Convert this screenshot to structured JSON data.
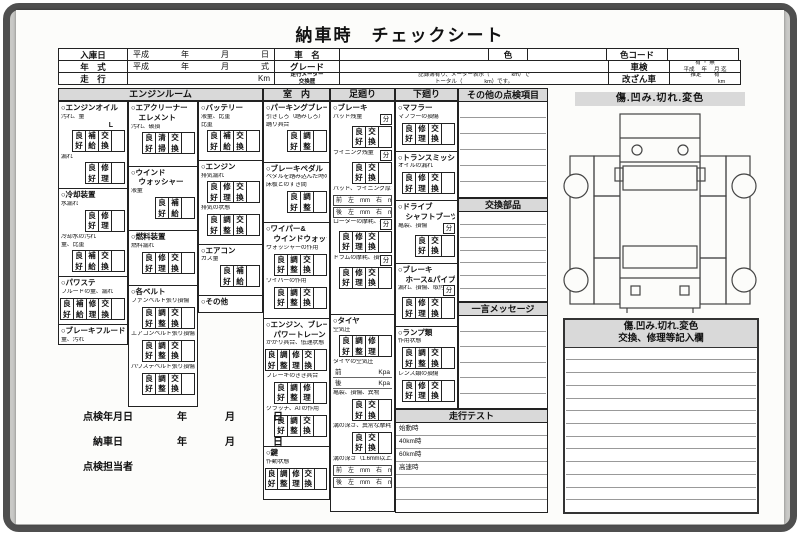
{
  "title": "納車時　チェックシート",
  "bun_label": "分",
  "colors": {
    "mat": "#c9c9c6",
    "frame": "#4f4f4f",
    "paper": "#fcfcfa",
    "shade": "#d9d9d9",
    "line": "#222222"
  },
  "header": {
    "rows": [
      [
        {
          "t": "入庫日",
          "w": 70,
          "h": true
        },
        {
          "t": "平成　　　　年　　　　月　　　　日",
          "w": 148
        },
        {
          "t": "車　名",
          "w": 66,
          "h": true
        },
        {
          "t": "",
          "w": 150
        },
        {
          "t": "色",
          "w": 40,
          "h": true
        },
        {
          "t": "",
          "w": 80
        },
        {
          "t": "色コード",
          "w": 62,
          "h": true
        },
        {
          "t": "",
          "w": 72
        }
      ],
      [
        {
          "t": "年　式",
          "w": 70,
          "h": true
        },
        {
          "t": "平成　　　　年　　　　月　　　　式",
          "w": 148
        },
        {
          "t": "グレード",
          "w": 66,
          "h": true
        },
        {
          "t": "",
          "w": 270
        },
        {
          "t": "車検",
          "w": 62,
          "h": true
        },
        {
          "t": "有 ・ 無\n平成　 年　 月 迄",
          "w": 72,
          "tiny": true
        }
      ],
      [
        {
          "t": "走　行",
          "w": 70,
          "h": true
        },
        {
          "t": "Km",
          "w": 148,
          "align": "right"
        },
        {
          "t": "走行メーター\n交換歴",
          "w": 66,
          "h": true,
          "tiny": true
        },
        {
          "t": "記録簿有り、メーター表示（　　　　km）で\nトータル（　　　　km）です。",
          "w": 270,
          "tiny": true
        },
        {
          "t": "改ざん車",
          "w": 62,
          "h": true
        },
        {
          "t": "推定　　 有\n　　　　　　km",
          "w": 72,
          "tiny": true
        }
      ]
    ]
  },
  "col_headers": {
    "engine_room": "エンジンルーム",
    "interior": "室　内",
    "suspension": "足廻り",
    "lower": "下廻り"
  },
  "engine_room": {
    "columns": [
      {
        "sections": [
          {
            "title": [
              "○エンジンオイル"
            ],
            "items": [
              {
                "label": "汚れ、量",
                "extra": "L",
                "boxes": [
                  "良好",
                  "補給",
                  "交換"
                ]
              },
              {
                "label": "漏れ",
                "boxes": [
                  "良好",
                  "修理"
                ]
              }
            ]
          },
          {
            "title": [
              "○冷却装置"
            ],
            "items": [
              {
                "label": "水漏れ",
                "boxes": [
                  "良好",
                  "修理"
                ]
              },
              {
                "label": "冷却水の汚れ",
                "label2": "量、比重",
                "boxes": [
                  "良好",
                  "補給",
                  "交換"
                ]
              }
            ]
          },
          {
            "title": [
              "○パワステ"
            ],
            "items": [
              {
                "label": "フルードの量、漏れ",
                "boxes": [
                  "良好",
                  "補給",
                  "修理",
                  "交換"
                ]
              }
            ]
          },
          {
            "title": [
              "○ブレーキフルード"
            ],
            "items": [
              {
                "label": "量、汚れ",
                "boxes": [
                  "良好",
                  "補給",
                  "交換"
                ]
              }
            ]
          }
        ]
      },
      {
        "sections": [
          {
            "title": [
              "○エアクリーナー",
              "　エレメント"
            ],
            "items": [
              {
                "label": "汚れ、破損",
                "boxes": [
                  "良好",
                  "清掃",
                  "交換"
                ]
              }
            ]
          },
          {
            "title": [
              "○ウインド",
              "　ウォッシャー"
            ],
            "items": [
              {
                "label": "液量",
                "boxes": [
                  "良好",
                  "補給"
                ]
              }
            ]
          },
          {
            "title": [
              "○燃料装置"
            ],
            "items": [
              {
                "label": "燃料漏れ",
                "boxes": [
                  "良好",
                  "修理",
                  "交換"
                ]
              }
            ]
          },
          {
            "title": [
              "○各ベルト"
            ],
            "items": [
              {
                "label": "ファンベルト張り損傷",
                "boxes": [
                  "良好",
                  "調整",
                  "交換"
                ]
              },
              {
                "label": "エアコンベルト張り損傷",
                "boxes": [
                  "良好",
                  "調整",
                  "交換"
                ]
              },
              {
                "label": "パワステベルト張り損傷",
                "boxes": [
                  "良好",
                  "調整",
                  "交換"
                ]
              }
            ]
          }
        ]
      },
      {
        "sections": [
          {
            "title": [
              "○バッテリー"
            ],
            "items": [
              {
                "label": "液量、比重",
                "label2": "比重",
                "boxes": [
                  "良好",
                  "補給",
                  "交換"
                ]
              }
            ]
          },
          {
            "title": [
              "○エンジン"
            ],
            "items": [
              {
                "label": "排気漏れ",
                "boxes": [
                  "良好",
                  "修理",
                  "交換"
                ]
              },
              {
                "label": "排気の状態",
                "boxes": [
                  "良好",
                  "調整",
                  "交換"
                ]
              }
            ]
          },
          {
            "title": [
              "○エアコン"
            ],
            "items": [
              {
                "label": "ガス量",
                "boxes": [
                  "良好",
                  "補給"
                ]
              }
            ]
          },
          {
            "title": [
              "○その他"
            ],
            "items": []
          }
        ]
      }
    ]
  },
  "interior": {
    "sections": [
      {
        "title": [
          "○パーキングブレーキ"
        ],
        "items": [
          {
            "label": "引きしろ（踏みしろ）",
            "label2": "踊り具合",
            "boxes": [
              "良好",
              "調整"
            ]
          }
        ]
      },
      {
        "title": [
          "○ブレーキペダル"
        ],
        "items": [
          {
            "label": "ペダルを踏み込んだ時の",
            "label2": "床板とのすき間",
            "boxes": [
              "良好",
              "調整"
            ]
          }
        ]
      },
      {
        "title": [
          "○ワイパー&",
          "　ウインドウォッシャー"
        ],
        "items": [
          {
            "label": "ウォッシャーの作用",
            "boxes": [
              "良好",
              "調整",
              "交換"
            ]
          },
          {
            "label": "ワイパーの作用",
            "boxes": [
              "良好",
              "調整",
              "交換"
            ]
          }
        ]
      },
      {
        "title": [
          "○エンジン、ブレーキ",
          "　パワートレーン"
        ],
        "items": [
          {
            "label": "かかり具合、低速状態",
            "boxes": [
              "良好",
              "調整",
              "修理",
              "交換"
            ]
          },
          {
            "label": "ブレーキのきき具合",
            "boxes": [
              "良好",
              "調整",
              "修理"
            ]
          },
          {
            "label": "クラッチ、ATの作用",
            "boxes": [
              "良好",
              "調整",
              "交換"
            ]
          }
        ]
      },
      {
        "title": [
          "○鍵"
        ],
        "items": [
          {
            "label": "作動状態",
            "boxes": [
              "良好",
              "調整",
              "修理",
              "交換"
            ]
          }
        ]
      }
    ]
  },
  "suspension": {
    "sections": [
      {
        "title": [
          "○ブレーキ"
        ],
        "items": [
          {
            "label": "パッド残量",
            "bun": true,
            "boxes": [
              "良好",
              "交換"
            ]
          },
          {
            "label": "ライニング残量",
            "bun": true,
            "boxes": [
              "良好",
              "交換"
            ]
          },
          {
            "label": "パッド、ライニング厚さ",
            "mm": [
              [
                "前",
                "左",
                "mm",
                "右",
                "mm"
              ],
              [
                "後",
                "左",
                "mm",
                "右",
                "mm"
              ]
            ]
          },
          {
            "label": "ローターの摩耗、損傷",
            "bun": true,
            "boxes": [
              "良好",
              "修理",
              "交換"
            ]
          },
          {
            "label": "ドラムの摩耗、損傷",
            "bun": true,
            "boxes": [
              "良好",
              "修理",
              "交換"
            ]
          }
        ]
      },
      {
        "title": [
          "○タイヤ"
        ],
        "items": [
          {
            "label": "空気圧",
            "boxes": [
              "良好",
              "調整",
              "修理"
            ]
          },
          {
            "label": "タイヤの空気圧",
            "kpa": [
              [
                "前",
                "Kpa"
              ],
              [
                "後",
                "Kpa"
              ]
            ]
          },
          {
            "label": "亀裂、損傷、異物",
            "boxes": [
              "良好",
              "交換"
            ]
          },
          {
            "label": "溝の深さ、異常な摩耗",
            "boxes": [
              "良好",
              "交換"
            ]
          },
          {
            "label": "溝の深さ（1.6mm以上）",
            "mm": [
              [
                "前",
                "左",
                "mm",
                "右",
                "mm"
              ],
              [
                "後",
                "左",
                "mm",
                "右",
                "mm"
              ]
            ]
          }
        ]
      }
    ]
  },
  "lower": {
    "sections": [
      {
        "title": [
          "○マフラー"
        ],
        "items": [
          {
            "label": "マフラーの損傷",
            "boxes": [
              "良好",
              "修理",
              "交換"
            ]
          }
        ]
      },
      {
        "title": [
          "○トランスミッション"
        ],
        "items": [
          {
            "label": "オイルの漏れ",
            "boxes": [
              "良好",
              "修理",
              "交換"
            ]
          }
        ]
      },
      {
        "title": [
          "○ドライブ",
          "　シャフトブーツ"
        ],
        "items": [
          {
            "label": "亀裂、損傷",
            "bun": true,
            "boxes": [
              "良好",
              "交換"
            ]
          }
        ]
      },
      {
        "title": [
          "○ブレーキ",
          "　ホース&パイプ"
        ],
        "items": [
          {
            "label": "漏れ、損傷、取付状態",
            "bun": true,
            "boxes": [
              "良好",
              "修理",
              "交換"
            ]
          }
        ]
      },
      {
        "title": [
          "○ランプ類"
        ],
        "items": [
          {
            "label": "作用状態",
            "boxes": [
              "良好",
              "調整",
              "交換"
            ]
          },
          {
            "label": "レンズ類の損傷",
            "boxes": [
              "良好",
              "修理",
              "交換"
            ]
          }
        ]
      }
    ]
  },
  "misc": {
    "other_title": "その他の点検項目",
    "other_lines": 6,
    "parts_title": "交換部品",
    "parts_lines": 7,
    "message_title": "一言メッセージ",
    "message_lines": 6
  },
  "road_test": {
    "title": "走行テスト",
    "rows": [
      "始動時",
      "40km時",
      "60km時",
      "高速時",
      "",
      "",
      ""
    ]
  },
  "damage": {
    "title": "傷.凹み.切れ.変色"
  },
  "notes": {
    "title_line1": "傷.凹み.切れ.変色",
    "title_line2": "交換、修理等記入欄",
    "lines": 13
  },
  "footer": {
    "rows": [
      {
        "label": "点検年月日",
        "units": [
          "年",
          "月",
          "日"
        ]
      },
      {
        "label": "納車日",
        "units": [
          "年",
          "月",
          "日"
        ]
      },
      {
        "label": "点検担当者",
        "units": []
      }
    ]
  }
}
